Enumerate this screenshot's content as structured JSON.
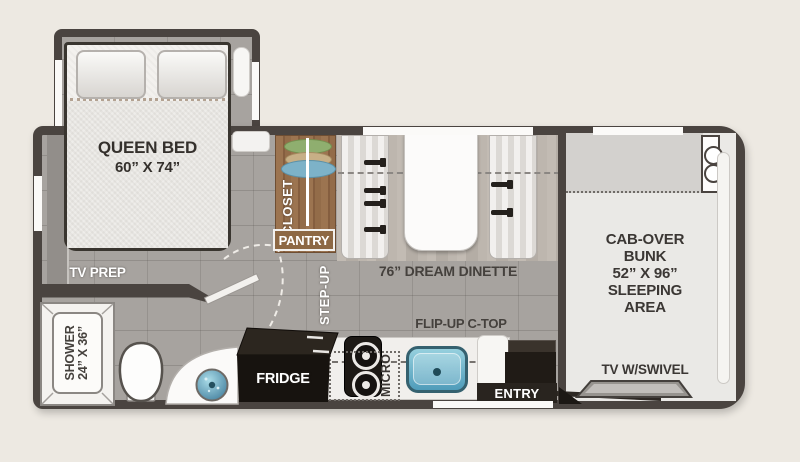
{
  "labels": {
    "queen_bed_line1": "QUEEN BED",
    "queen_bed_line2": "60” X 74”",
    "tv_prep": "TV PREP",
    "closet": "CLOSET",
    "pantry": "PANTRY",
    "step_up": "STEP-UP",
    "dinette": "76” DREAM DINETTE",
    "cab_over_lines": [
      "CAB-OVER",
      "BUNK",
      "52” X 96”",
      "SLEEPING",
      "AREA"
    ],
    "tv_swivel": "TV W/SWIVEL",
    "flip_up_ctop": "FLIP-UP C-TOP",
    "micro": "MICRO",
    "fridge": "FRIDGE",
    "entry": "ENTRY",
    "shower_line1": "SHOWER",
    "shower_line2": "24” X 36”"
  },
  "colors": {
    "background": "#ede9e2",
    "wall": "#4a4440",
    "floor_gray": "#a7a39f",
    "closet_wood": "#9a7048",
    "sink_blue": "#5fa8c4",
    "appliance_black": "#17130f",
    "label_dark": "#3e3a36",
    "label_light": "#ffffff"
  }
}
